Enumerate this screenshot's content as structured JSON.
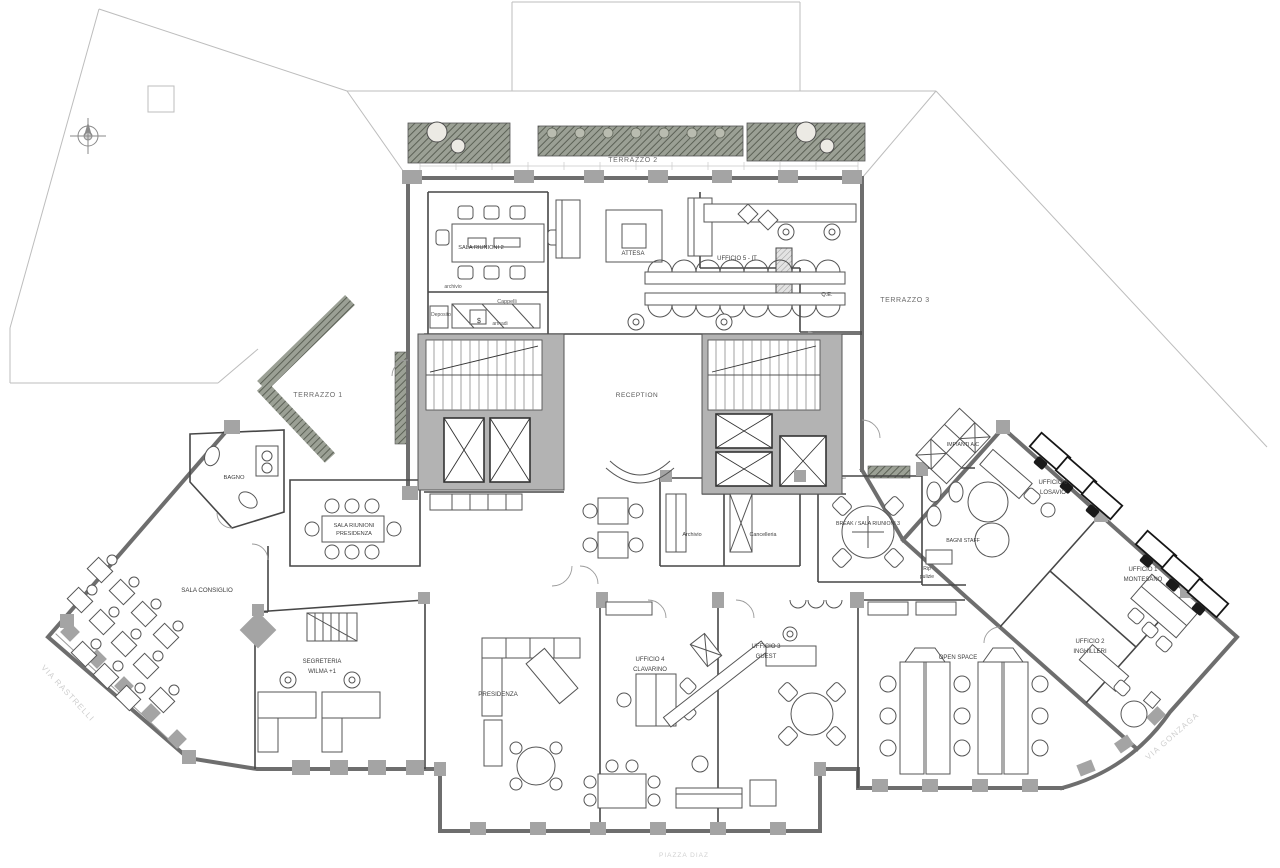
{
  "meta": {
    "drawing_type": "architectural office floor plan",
    "canvas": {
      "w": 1280,
      "h": 868
    }
  },
  "colors": {
    "background": "#ffffff",
    "exterior_wall": "#6e6e6e",
    "partition": "#474747",
    "poche_fill": "#b3b3b3",
    "site_line": "#bdbdbd",
    "planter_fill": "#9ba095",
    "planter_hatch": "#5c6156",
    "furniture_line": "#555555",
    "black_furniture": "#161616",
    "room_label": "#3d3d3d",
    "terrace_label": "#6a6a6a",
    "street_label": "#cfcfcf"
  },
  "labels": [
    {
      "id": "terrazzo-2",
      "text": "TERRAZZO 2",
      "x": 633,
      "y": 162,
      "size": 7,
      "color": "#6a6a6a",
      "ls": 0.6
    },
    {
      "id": "terrazzo-1",
      "text": "TERRAZZO 1",
      "x": 318,
      "y": 397,
      "size": 7,
      "color": "#6a6a6a",
      "ls": 0.6
    },
    {
      "id": "terrazzo-3",
      "text": "TERRAZZO 3",
      "x": 905,
      "y": 302,
      "size": 7,
      "color": "#6a6a6a",
      "ls": 0.6
    },
    {
      "id": "sala-riunioni-2",
      "text": "SALA RIUNIONI 2",
      "x": 481,
      "y": 249,
      "size": 5.6
    },
    {
      "id": "attesa",
      "text": "ATTESA",
      "x": 633,
      "y": 255,
      "size": 6
    },
    {
      "id": "ufficio-5-it",
      "text": "UFFICIO 5 - IT",
      "x": 737,
      "y": 260,
      "size": 6
    },
    {
      "id": "qe",
      "text": "Q.E.",
      "x": 827,
      "y": 296,
      "size": 5.6
    },
    {
      "id": "reception",
      "text": "RECEPTION",
      "x": 637,
      "y": 397,
      "size": 6.5,
      "color": "#555555",
      "ls": 0.5
    },
    {
      "id": "archivio-dep",
      "text": "archivio",
      "x": 453,
      "y": 288,
      "size": 5,
      "color": "#555555"
    },
    {
      "id": "cappelli",
      "text": "Cappelli",
      "x": 507,
      "y": 303,
      "size": 5.4,
      "color": "#555555"
    },
    {
      "id": "deposito",
      "text": "Deposito",
      "x": 441,
      "y": 316,
      "size": 5,
      "color": "#555555"
    },
    {
      "id": "armadi",
      "text": "armadi",
      "x": 500,
      "y": 325,
      "size": 5,
      "color": "#555555"
    },
    {
      "id": "safe-symbol",
      "text": "$",
      "x": 479,
      "y": 323,
      "size": 7
    },
    {
      "id": "bagno",
      "text": "BAGNO",
      "x": 234,
      "y": 479,
      "size": 5.8
    },
    {
      "id": "sala-riunioni-presidenza-1",
      "text": "SALA RIUNIONI",
      "x": 354,
      "y": 527,
      "size": 5.6
    },
    {
      "id": "sala-riunioni-presidenza-2",
      "text": "PRESIDENZA",
      "x": 354,
      "y": 535,
      "size": 5.6
    },
    {
      "id": "sala-consiglio",
      "text": "SALA CONSIGLIO",
      "x": 207,
      "y": 592,
      "size": 6.2
    },
    {
      "id": "segreteria-1",
      "text": "SEGRETERIA",
      "x": 322,
      "y": 663,
      "size": 6
    },
    {
      "id": "segreteria-2",
      "text": "WILMA +1",
      "x": 322,
      "y": 673,
      "size": 6
    },
    {
      "id": "presidenza",
      "text": "PRESIDENZA",
      "x": 498,
      "y": 696,
      "size": 6.2
    },
    {
      "id": "ufficio-4-1",
      "text": "UFFICIO 4",
      "x": 650,
      "y": 661,
      "size": 6
    },
    {
      "id": "ufficio-4-2",
      "text": "CLAVARINO",
      "x": 650,
      "y": 671,
      "size": 6
    },
    {
      "id": "ufficio-3-1",
      "text": "UFFICIO 3",
      "x": 766,
      "y": 648,
      "size": 6
    },
    {
      "id": "ufficio-3-2",
      "text": "GUEST",
      "x": 766,
      "y": 658,
      "size": 6
    },
    {
      "id": "break-sala-riunioni-3",
      "text": "BREAK / SALA RIUNIONI 3",
      "x": 868,
      "y": 525,
      "size": 5.2
    },
    {
      "id": "bagni-staff",
      "text": "BAGNI STAFF",
      "x": 963,
      "y": 542,
      "size": 5.2
    },
    {
      "id": "rip-pulizie-1",
      "text": "Rip",
      "x": 927,
      "y": 570,
      "size": 5
    },
    {
      "id": "rip-pulizie-2",
      "text": "pulizie",
      "x": 927,
      "y": 578,
      "size": 5
    },
    {
      "id": "impianti-ac",
      "text": "IMPIANTI A/C",
      "x": 963,
      "y": 446,
      "size": 5.2
    },
    {
      "id": "ufficio-6-1",
      "text": "UFFICIO 6",
      "x": 1053,
      "y": 484,
      "size": 6
    },
    {
      "id": "ufficio-6-2",
      "text": "LOSAVIO",
      "x": 1053,
      "y": 494,
      "size": 6
    },
    {
      "id": "open-space",
      "text": "OPEN SPACE",
      "x": 958,
      "y": 659,
      "size": 6
    },
    {
      "id": "ufficio-2-1",
      "text": "UFFICIO 2",
      "x": 1090,
      "y": 643,
      "size": 6
    },
    {
      "id": "ufficio-2-2",
      "text": "INGHILLERI",
      "x": 1090,
      "y": 653,
      "size": 6
    },
    {
      "id": "ufficio-1-1",
      "text": "UFFICIO 1",
      "x": 1143,
      "y": 571,
      "size": 6
    },
    {
      "id": "ufficio-1-2",
      "text": "MONTESANO",
      "x": 1143,
      "y": 581,
      "size": 6
    },
    {
      "id": "archivio-room",
      "text": "Archivio",
      "x": 692,
      "y": 536,
      "size": 5.4
    },
    {
      "id": "cancelleria",
      "text": "Cancelleria",
      "x": 763,
      "y": 536,
      "size": 5.4
    },
    {
      "id": "via-rastrelli",
      "text": "VIA RASTRELLI",
      "x": 66,
      "y": 695,
      "size": 8,
      "color": "#cfcfcf",
      "rot": 47,
      "ls": 1.2
    },
    {
      "id": "via-gonzaga",
      "text": "VIA GONZAGA",
      "x": 1174,
      "y": 738,
      "size": 8,
      "color": "#cfcfcf",
      "rot": -41,
      "ls": 1.2
    },
    {
      "id": "piazza-diaz",
      "text": "PIAZZA DIAZ",
      "x": 684,
      "y": 857,
      "size": 6.5,
      "color": "#d0d0d0",
      "ls": 1
    }
  ]
}
